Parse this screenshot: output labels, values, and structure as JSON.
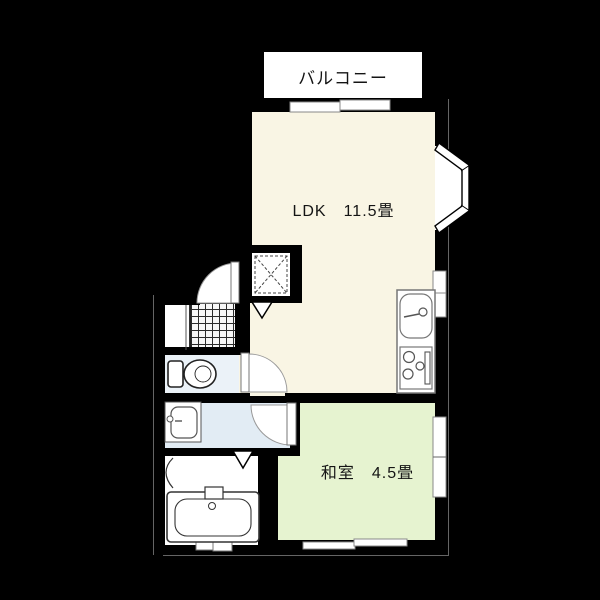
{
  "labels": {
    "balcony": "バルコニー",
    "ldk": "LDK　11.5畳",
    "washitsu": "和室　4.5畳"
  },
  "colors": {
    "background": "#000000",
    "wall": "#000000",
    "ldk_floor": "#F9F5E4",
    "washitsu_floor": "#E6F3D0",
    "wet_floor": "#E2ECF4",
    "toilet_floor": "#EBF2F8"
  },
  "fixtures": {
    "bay_window": "bay-window",
    "balcony_door": "sliding-window",
    "kitchen": "sink-and-stove",
    "closet": "closet-x-symbol",
    "entrance": "entrance-door-swing",
    "genkan_floor": "tile-floor",
    "toilet": "toilet-fixture",
    "washbasin": "washbasin-fixture",
    "bath": "bathtub-fixture",
    "folding_door": "triangle-door-marker"
  }
}
